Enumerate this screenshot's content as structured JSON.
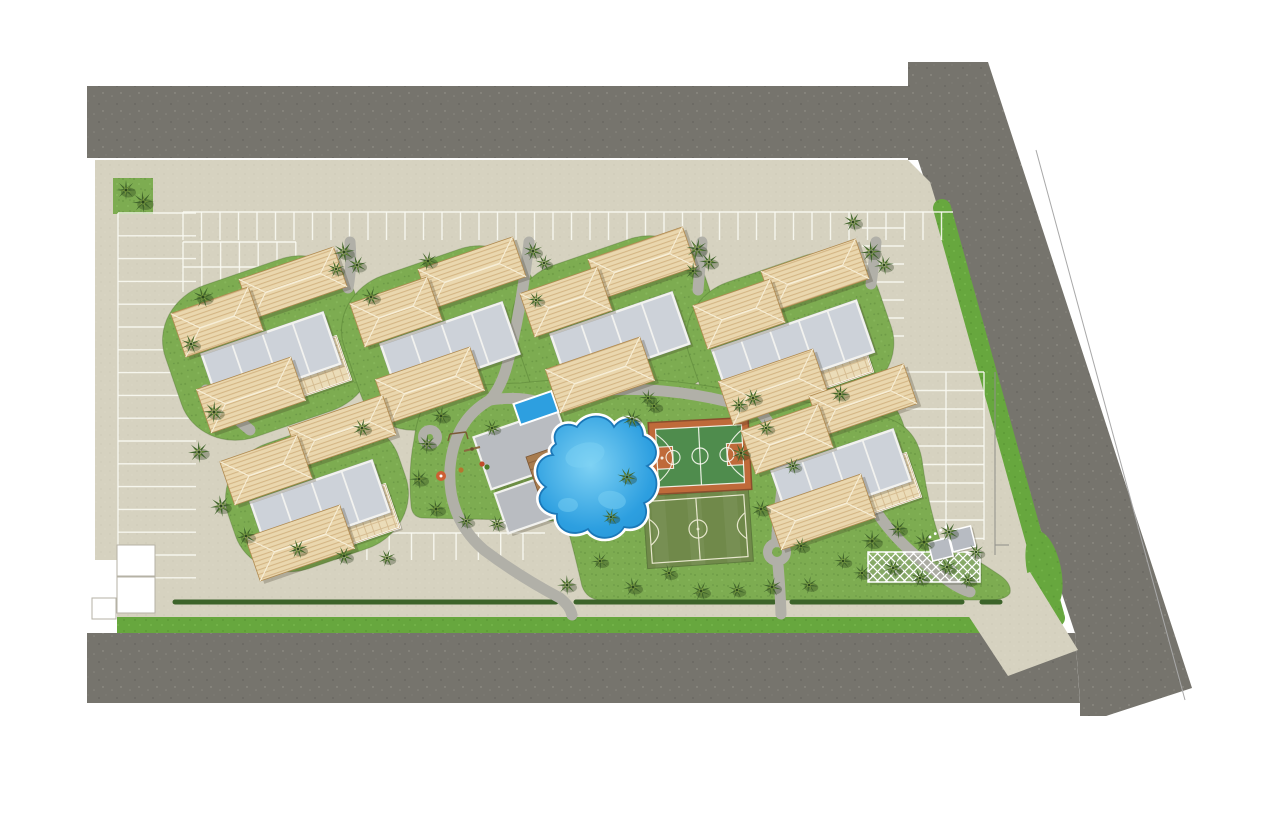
{
  "scene": {
    "width": 1280,
    "height": 825,
    "background": "#ffffff"
  },
  "palette": {
    "asphalt": "pattern:asphaltTex",
    "pavement": "pattern:pavementTex",
    "grass": "pattern:lawnTex",
    "grassBright": "pattern:grassBrightTex",
    "hedge": "#3c632a",
    "path": "#b1b0a8",
    "line_white": "rgba(250,249,242,0.9)",
    "roof_base": "#ead7ae",
    "roof_stripe": "#d2b381",
    "roof_edge": "#b08a50",
    "roof_ridge": "#f7eed6",
    "flat_roof": "#cdd2d9",
    "flat_stroke": "#f2f2ef",
    "flat_outline": "#8c919b",
    "patio": "#ebdcb8",
    "patio_line": "#d6bd92",
    "deck_wood": "#a87c4f",
    "plank_line": "#8a613c",
    "pool_blue": "#2d9fe0",
    "pool_light": "#7fd2f4",
    "pool_dark": "#1b78b8",
    "court_green": "#4f8c4d",
    "court_clay": "#bf6a3a",
    "court_edge": "#8a4e2d",
    "field_green": "#70894a",
    "field_line": "#e7e7cd",
    "boundary": "#a8a8a8",
    "white": "#ffffff",
    "lounger": "#f3ecda",
    "shadow": "rgba(60,50,30,0.25)",
    "tree_dark": "#41652c",
    "tree_light": "#7d9c3e",
    "tree_core": "#2d471d",
    "fence": "#8f8f89"
  },
  "roads": [
    {
      "name": "road-top",
      "points": "87,86 955,86 955,158 87,158"
    },
    {
      "name": "road-diagonal",
      "points": "908,62 988,62 1192,688 1106,716 1080,716 1080,701 1075,633 918,160 908,160"
    },
    {
      "name": "road-bottom",
      "points": "87,633 1075,633 1080,703 87,703"
    }
  ],
  "boundary_line": {
    "x1": 1036,
    "y1": 150,
    "x2": 1185,
    "y2": 700
  },
  "pavement_polygon": "95,160 908,160 930,182 1062,612 1062,617 988,617 117,617 117,560 95,560",
  "green_strips": {
    "bottom": "117,617 1000,617 1008,633 117,633",
    "diagonal": {
      "x1": 942,
      "y1": 208,
      "x2": 1056,
      "y2": 618,
      "width": 18
    },
    "entrance_bulge": {
      "cx": 1044,
      "cy": 570,
      "rx": 17,
      "ry": 40,
      "rot": -12
    },
    "topleft_square": {
      "x": 113,
      "y": 178,
      "w": 40,
      "h": 36
    }
  },
  "entrance_driveway": "958,600 1030,572 1078,650 1008,676",
  "hedge_segments": [
    [
      175,
      556
    ],
    [
      576,
      774
    ],
    [
      792,
      962
    ],
    [
      982,
      1000
    ]
  ],
  "hedge_y": 602,
  "white_structures": [
    {
      "x": 117,
      "y": 545,
      "w": 38,
      "h": 31
    },
    {
      "x": 117,
      "y": 577,
      "w": 38,
      "h": 36
    },
    {
      "x": 92,
      "y": 598,
      "w": 24,
      "h": 21
    }
  ],
  "parking_rows": [
    {
      "name": "parking-row-top",
      "orient": "v",
      "from": 183,
      "to": 953,
      "step": 18.5,
      "a": 212,
      "b": 240,
      "edge": 212
    },
    {
      "name": "parking-row-top-left",
      "orient": "v",
      "from": 183,
      "to": 296,
      "step": 18.8,
      "a": 242,
      "b": 292,
      "edge": 242,
      "mid": 267
    },
    {
      "name": "parking-row-left",
      "orient": "h",
      "from": 213,
      "to": 578,
      "step": 22.8,
      "a": 118,
      "b": 196,
      "edge": 118
    },
    {
      "name": "parking-row-inner",
      "orient": "v",
      "from": 300,
      "to": 545,
      "step": 22.3,
      "a": 533,
      "b": 560,
      "edge": 533
    },
    {
      "name": "parking-row-right-upper",
      "orient": "h",
      "from": 228,
      "to": 345,
      "step": 18,
      "a": 862,
      "b": 904
    },
    {
      "name": "parking-row-right",
      "orient": "h",
      "from": 372,
      "to": 540,
      "step": 18.5,
      "a": 906,
      "b": 984,
      "edge": 984,
      "mid": 946
    }
  ],
  "cluster_template": {
    "roof_top": [
      25,
      -55,
      100,
      42
    ],
    "roof_left": [
      -51,
      -16,
      82,
      46
    ],
    "gray_row": [
      3,
      21,
      128,
      54
    ],
    "roof_bottom": [
      -17,
      57,
      100,
      46
    ],
    "patio": [
      49,
      29,
      56,
      46
    ]
  },
  "clusters": [
    {
      "cx": 268,
      "cy": 338,
      "rot": -19,
      "patio": true,
      "panels": 4,
      "lawn": [
        200,
        160
      ]
    },
    {
      "cx": 447,
      "cy": 328,
      "rot": -19,
      "patio": false,
      "panels": 4,
      "lawn": [
        200,
        160
      ]
    },
    {
      "cx": 617,
      "cy": 318,
      "rot": -19,
      "patio": false,
      "panels": 4,
      "lawn": [
        200,
        160
      ]
    },
    {
      "cx": 790,
      "cy": 330,
      "rot": -19,
      "patio": true,
      "panels": 5,
      "lawn": [
        200,
        150
      ]
    },
    {
      "cx": 317,
      "cy": 486,
      "rot": -19,
      "patio": true,
      "panels": 4,
      "lawn": [
        180,
        132
      ]
    },
    {
      "cx": 838,
      "cy": 455,
      "rot": -19,
      "patio": true,
      "panels": 4,
      "lawn": [
        150,
        150
      ]
    }
  ],
  "park_lawn_path": "M433,393 Q470,384 520,383 Q585,376 640,379 Q700,382 760,396 Q830,404 880,416 Q916,424 922,460 Q928,505 940,540 Q970,555 998,574 Q1012,583 1010,593 Q1006,600 988,600 L602,600 Q587,600 582,586 Q575,555 568,530 Q566,522 556,521 L424,518 Q412,518 411,505 Q408,470 414,440 Q418,408 433,393 Z",
  "walkways": [
    "M350,242 Q352,266 348,288",
    "M529,242 Q522,305 508,362 Q502,386 490,400",
    "M702,242 Q700,266 698,290",
    "M876,242 Q874,264 871,284",
    "M490,400 Q454,420 450,468 Q447,518 484,550 Q520,577 560,598 Q570,606 572,615",
    "M608,390 Q680,386 758,410",
    "M758,410 Q790,440 780,505 Q776,532 777,550",
    "M777,554 Q780,584 781,614",
    "M780,468 Q818,462 856,466 Q880,468 898,466",
    "M878,514 Q898,544 934,570 Q956,588 970,592",
    "M206,390 Q228,412 250,430",
    "M490,400 Q520,396 538,402"
  ],
  "path_nodes": [
    [
      430,
      437,
      7
    ],
    [
      777,
      552,
      9
    ],
    [
      858,
      468,
      8
    ]
  ],
  "soccer_field": {
    "cx": 698,
    "cy": 529,
    "w": 106,
    "h": 72,
    "rot": -4
  },
  "basketball_court": {
    "cx": 700,
    "cy": 456,
    "w": 100,
    "h": 72,
    "rot": -3
  },
  "pool_path": "M556,444 C550,430 564,420 577,427 C585,414 606,412 614,427 C624,413 643,419 643,436 C658,441 661,459 647,466 C661,475 659,497 644,503 C651,517 640,531 624,527 C617,540 596,542 588,529 C574,538 555,531 557,514 C541,513 533,497 546,487 C531,477 536,456 553,455 C549,450 552,447 556,444 Z",
  "pool_highlights": [
    [
      585,
      455,
      20,
      12,
      -15
    ],
    [
      612,
      500,
      14,
      9,
      10
    ],
    [
      568,
      505,
      10,
      7,
      0
    ]
  ],
  "clubhouse": {
    "rot": -19,
    "bar": [
      524,
      449,
      88,
      55
    ],
    "foot": [
      529,
      504,
      58,
      42
    ],
    "deck": [
      554,
      477,
      40,
      56
    ],
    "lap_pool": [
      536,
      408,
      40,
      22
    ],
    "lounger_ys": [
      468,
      480,
      492
    ],
    "parasol": [
      441,
      476
    ]
  },
  "playground": {
    "swing": [
      458,
      436
    ],
    "seesaw": [
      472,
      449
    ],
    "toys": [
      [
        482,
        464,
        "#c04b2a"
      ],
      [
        487,
        467,
        "#4a7d2a"
      ],
      [
        461,
        470,
        "#b5762e"
      ]
    ]
  },
  "pergola": {
    "x": 868,
    "y": 552,
    "w": 112,
    "h": 30
  },
  "gatehouse": {
    "rot": -14,
    "panels": [
      [
        930,
        537,
        21,
        19
      ],
      [
        952,
        531,
        23,
        21
      ]
    ],
    "dots": [
      [
        933,
        532
      ],
      [
        939,
        530
      ],
      [
        945,
        528
      ],
      [
        951,
        526
      ]
    ]
  },
  "fences": [
    [
      995,
      372,
      995,
      555
    ],
    [
      995,
      545,
      1009,
      545
    ]
  ],
  "trees": [
    [
      126,
      190,
      10
    ],
    [
      143,
      202,
      11
    ],
    [
      344,
      252,
      11
    ],
    [
      357,
      265,
      10
    ],
    [
      336,
      269,
      9
    ],
    [
      533,
      251,
      10
    ],
    [
      544,
      263,
      9
    ],
    [
      697,
      249,
      11
    ],
    [
      709,
      262,
      10
    ],
    [
      693,
      271,
      9
    ],
    [
      871,
      252,
      11
    ],
    [
      884,
      265,
      10
    ],
    [
      853,
      222,
      10
    ],
    [
      203,
      297,
      11
    ],
    [
      191,
      344,
      10
    ],
    [
      371,
      297,
      10
    ],
    [
      428,
      261,
      10
    ],
    [
      536,
      300,
      9
    ],
    [
      214,
      412,
      11
    ],
    [
      199,
      452,
      11
    ],
    [
      221,
      506,
      11
    ],
    [
      246,
      536,
      10
    ],
    [
      298,
      549,
      10
    ],
    [
      344,
      556,
      10
    ],
    [
      387,
      558,
      9
    ],
    [
      362,
      428,
      10
    ],
    [
      441,
      416,
      10
    ],
    [
      427,
      444,
      10
    ],
    [
      419,
      479,
      10
    ],
    [
      436,
      509,
      10
    ],
    [
      466,
      521,
      9
    ],
    [
      497,
      524,
      9
    ],
    [
      492,
      428,
      9
    ],
    [
      632,
      419,
      10
    ],
    [
      627,
      477,
      10
    ],
    [
      611,
      517,
      9
    ],
    [
      648,
      398,
      9
    ],
    [
      567,
      585,
      10
    ],
    [
      600,
      561,
      9
    ],
    [
      633,
      587,
      10
    ],
    [
      669,
      573,
      9
    ],
    [
      701,
      591,
      10
    ],
    [
      737,
      590,
      9
    ],
    [
      772,
      587,
      10
    ],
    [
      809,
      585,
      9
    ],
    [
      843,
      561,
      9
    ],
    [
      654,
      406,
      9
    ],
    [
      739,
      405,
      9
    ],
    [
      766,
      428,
      9
    ],
    [
      793,
      466,
      9
    ],
    [
      753,
      398,
      10
    ],
    [
      741,
      453,
      10
    ],
    [
      761,
      509,
      10
    ],
    [
      801,
      546,
      9
    ],
    [
      840,
      394,
      10
    ],
    [
      872,
      541,
      11
    ],
    [
      898,
      529,
      10
    ],
    [
      924,
      542,
      11
    ],
    [
      949,
      532,
      10
    ],
    [
      893,
      568,
      10
    ],
    [
      920,
      578,
      10
    ],
    [
      947,
      567,
      10
    ],
    [
      968,
      580,
      9
    ],
    [
      976,
      552,
      9
    ],
    [
      862,
      573,
      9
    ]
  ]
}
